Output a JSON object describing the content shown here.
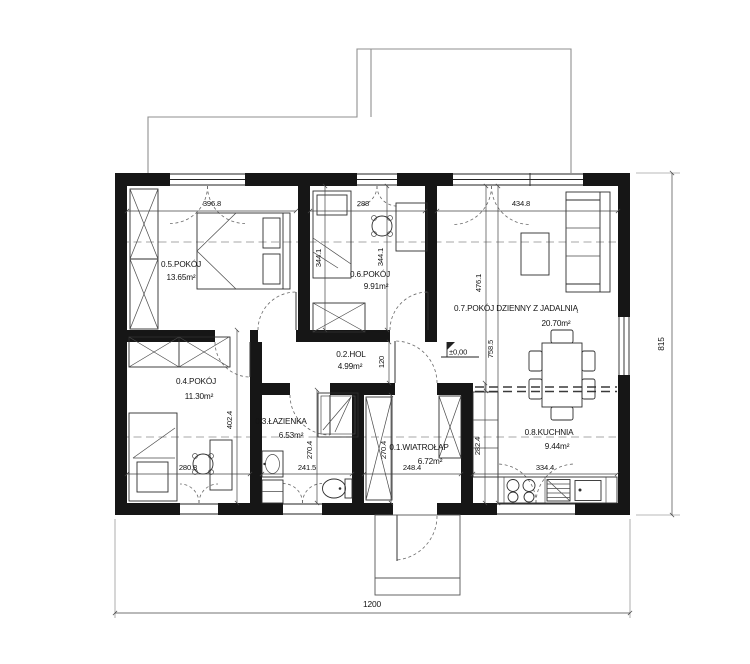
{
  "rooms": {
    "r01": {
      "label": "0.1.WIATROŁAP",
      "area": "6.72m²"
    },
    "r02": {
      "label": "0.2.HOL",
      "area": "4.99m²"
    },
    "r03": {
      "label": "0.3.ŁAZIENKA",
      "area": "6.53m²"
    },
    "r04": {
      "label": "0.4.POKÓJ",
      "area": "11.30m²"
    },
    "r05": {
      "label": "0.5.POKÓJ",
      "area": "13.65m²"
    },
    "r06": {
      "label": "0.6.POKÓJ",
      "area": "9.91m²"
    },
    "r07": {
      "label": "0.7.POKÓJ DZIENNY Z JADALNIĄ",
      "area": "20.70m²"
    },
    "r08": {
      "label": "0.8.KUCHNIA",
      "area": "9.44m²"
    }
  },
  "dims": {
    "r05_w": "396.8",
    "r05_h": "344.1",
    "r06_w": "288",
    "r06_h": "344.1",
    "r07_w": "434.8",
    "r07_h_upper": "476.1",
    "r07_h_full": "758.5",
    "r04_w": "280.8",
    "r04_h": "402.4",
    "r03_w": "241.5",
    "r03_h": "270.4",
    "r01_w": "248.4",
    "r01_h": "270.4",
    "r08_w": "334.4",
    "r08_h": "282.4",
    "hall_w": "120",
    "overall_w": "1200",
    "overall_h": "815"
  },
  "level_mark": "±0,00",
  "colors": {
    "wall": "#161616",
    "line": "#2e2e2e",
    "paper": "#ffffff"
  }
}
